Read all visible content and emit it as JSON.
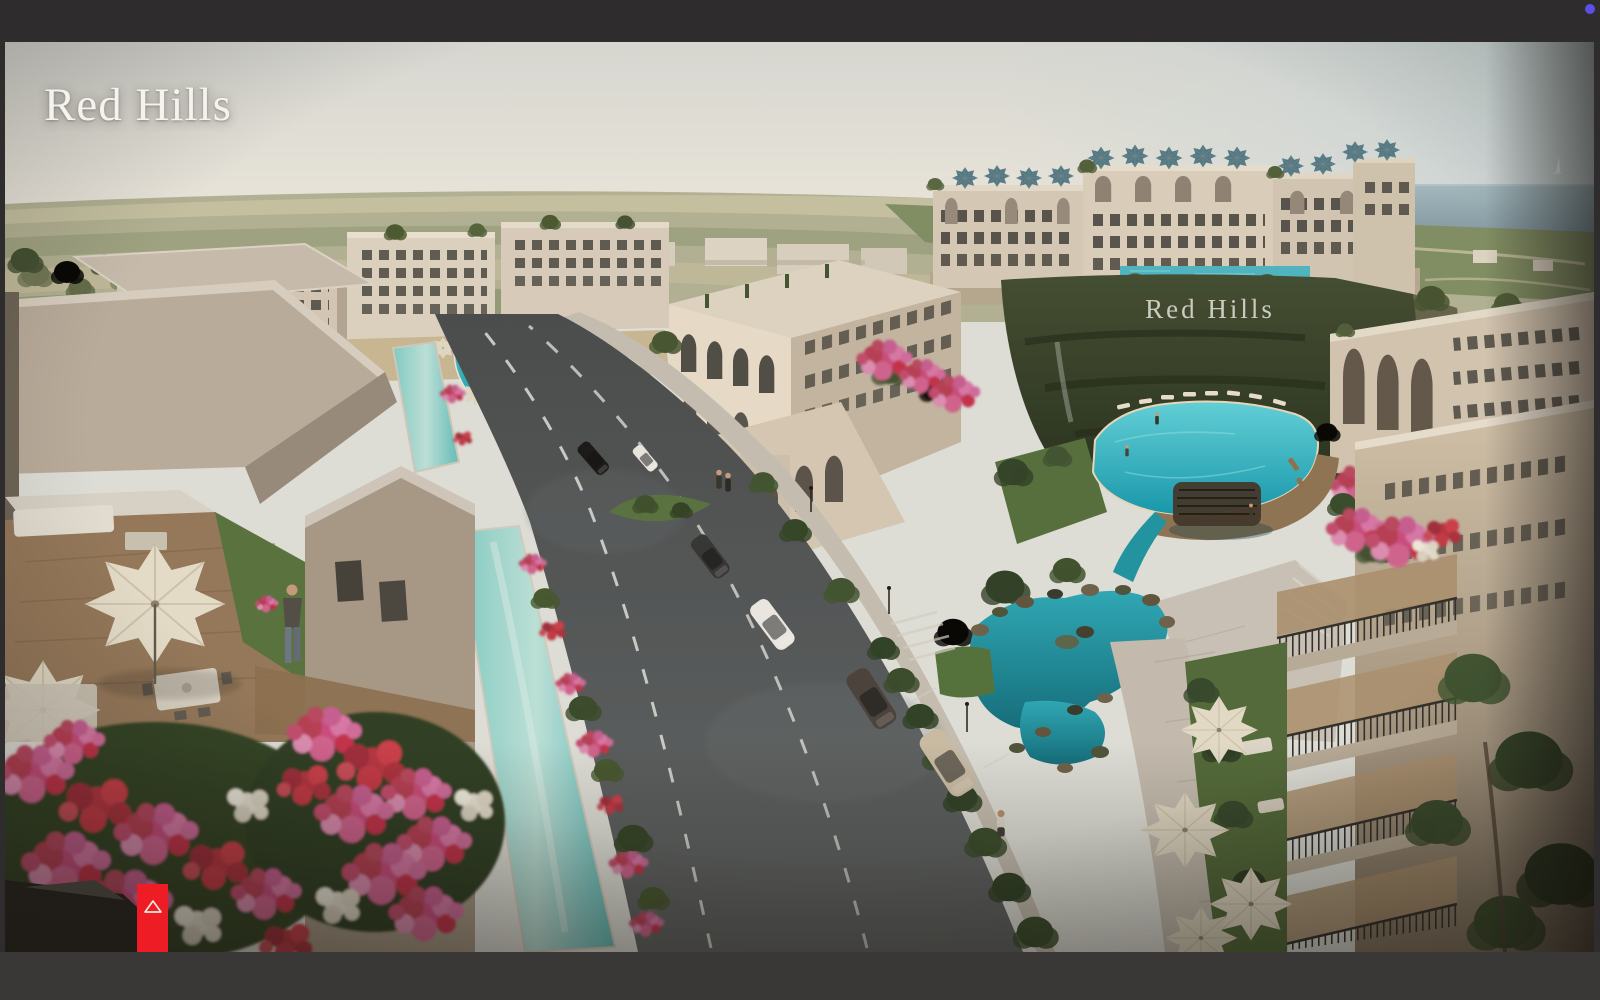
{
  "window": {
    "frame_color": "#2e2c2c",
    "bottom_bar_color": "#3a3837",
    "indicator_dot_color": "#5b4fe8"
  },
  "hero": {
    "brand_logo_text": "Red Hills",
    "hillside_sign_text": "Red Hills",
    "scroll_button": {
      "icon": "triangle-up-icon",
      "background_color": "#ee1c25",
      "icon_color": "#f2e9e0"
    }
  },
  "scene": {
    "palette": {
      "sky": "#e4e6e1",
      "sea": "#8ea7b1",
      "plains_olive": "#aeb092",
      "building_cream": "#d8cec0",
      "pool_turquoise": "#2ab5c6",
      "canal_seafoam": "#aedcd6",
      "lagoon_teal": "#13889c",
      "greenery_dark": "#3c4d2c",
      "flower_pink": "#d06ca0",
      "flower_red": "#b93848",
      "road_asphalt": "#55595c",
      "paving_light": "#c6c0b6",
      "umbrella_cream": "#e2dbc9",
      "umbrella_blue": "#57808f",
      "hill_green": "#323e27"
    }
  }
}
